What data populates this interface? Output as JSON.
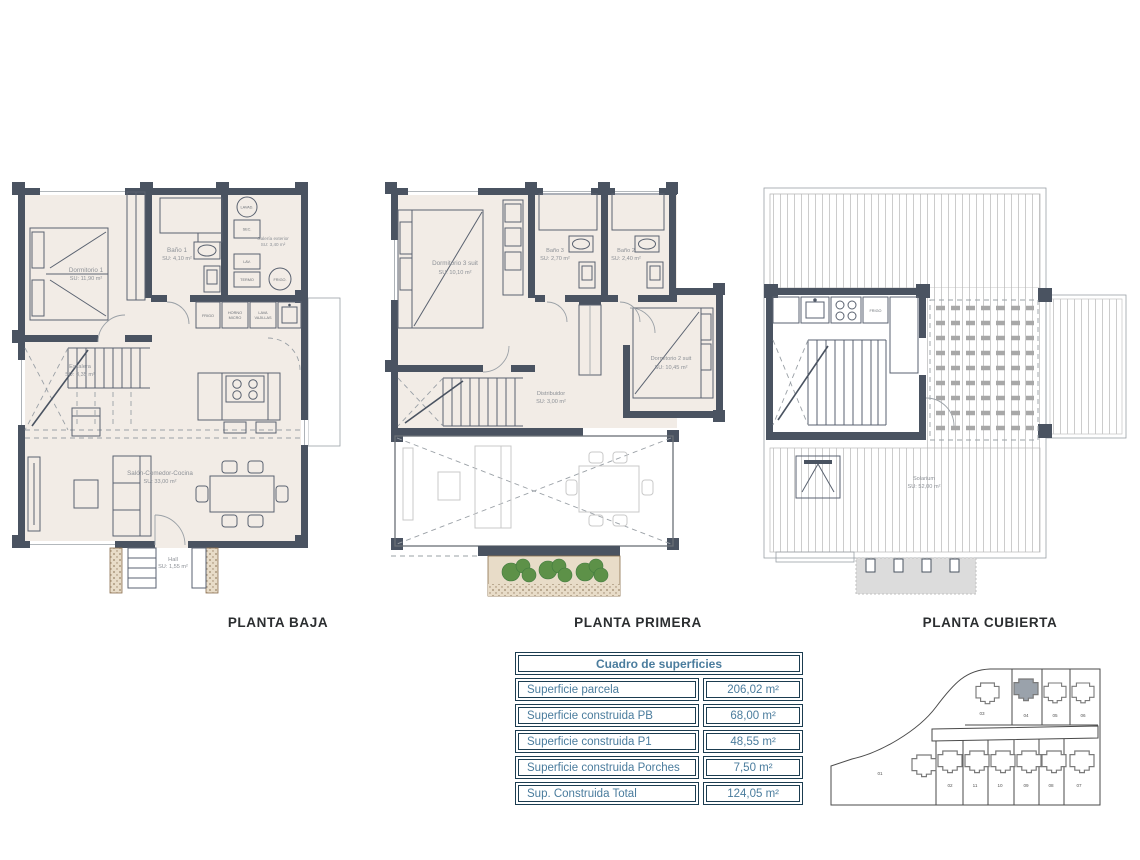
{
  "plans": {
    "baja": {
      "title": "PLANTA BAJA",
      "rooms": {
        "dormitorio1": "Dormitorio 1",
        "dormitorio1_su": "SU: 11,90 m²",
        "bano1": "Baño 1",
        "bano1_su": "SU: 4,10 m²",
        "galeria": "Galería exterior",
        "galeria_su": "SU: 3,40 m²",
        "escalera": "Escalera",
        "escalera_su": "SU: 3,35 m²",
        "salon": "Salón-Comedor-Cocina",
        "salon_su": "SU: 33,00 m²",
        "hall": "Hall",
        "hall_su": "SU: 1,55 m²"
      },
      "appliances": {
        "frigo": "FRIGO",
        "horno1": "HORNO",
        "horno2": "MICRO",
        "lava1": "LAVA",
        "lava2": "VAJILLAS",
        "lavad": "LAVAD.",
        "sec": "SEC.",
        "lav": "LAV.",
        "termo": "TERMO",
        "frigo_gal": "FRIGO."
      }
    },
    "primera": {
      "title": "PLANTA PRIMERA",
      "rooms": {
        "dormitorio3": "Dormitorio 3 suit",
        "dormitorio3_su": "SU: 10,10 m²",
        "bano3": "Baño 3",
        "bano3_su": "SU: 2,70 m²",
        "bano2": "Baño 2",
        "bano2_su": "SU: 2,40 m²",
        "dormitorio2": "Dormitorio 2 suit",
        "dormitorio2_su": "SU: 10,45 m²",
        "distribuidor": "Distribuidor",
        "distribuidor_su": "SU: 3,00 m²"
      }
    },
    "cubierta": {
      "title": "PLANTA CUBIERTA",
      "rooms": {
        "solarium": "Solarium",
        "solarium_su": "SU: 52,00 m²",
        "frigo": "FRIGO"
      }
    }
  },
  "table": {
    "title": "Cuadro de superficies",
    "rows": [
      {
        "label": "Superficie parcela",
        "value": "206,02 m²"
      },
      {
        "label": "Superficie construida PB",
        "value": "68,00 m²"
      },
      {
        "label": "Superficie construida P1",
        "value": "48,55 m²"
      },
      {
        "label": "Superficie construida Porches",
        "value": "7,50 m²"
      },
      {
        "label": "Sup. Construida Total",
        "value": "124,05 m²"
      }
    ]
  },
  "siteplan": {
    "open_plot": "01",
    "plots_top": [
      "03",
      "04",
      "05",
      "06"
    ],
    "plots_bottom": [
      "02",
      "11",
      "10",
      "09",
      "08",
      "07"
    ]
  },
  "colors": {
    "wall": "#4a5361",
    "floor": "#f2ece6",
    "table_text": "#4a7c9d",
    "table_border": "#1b3c50",
    "plant": "#5d9148",
    "highlight_plot": "#9aa2ab"
  }
}
